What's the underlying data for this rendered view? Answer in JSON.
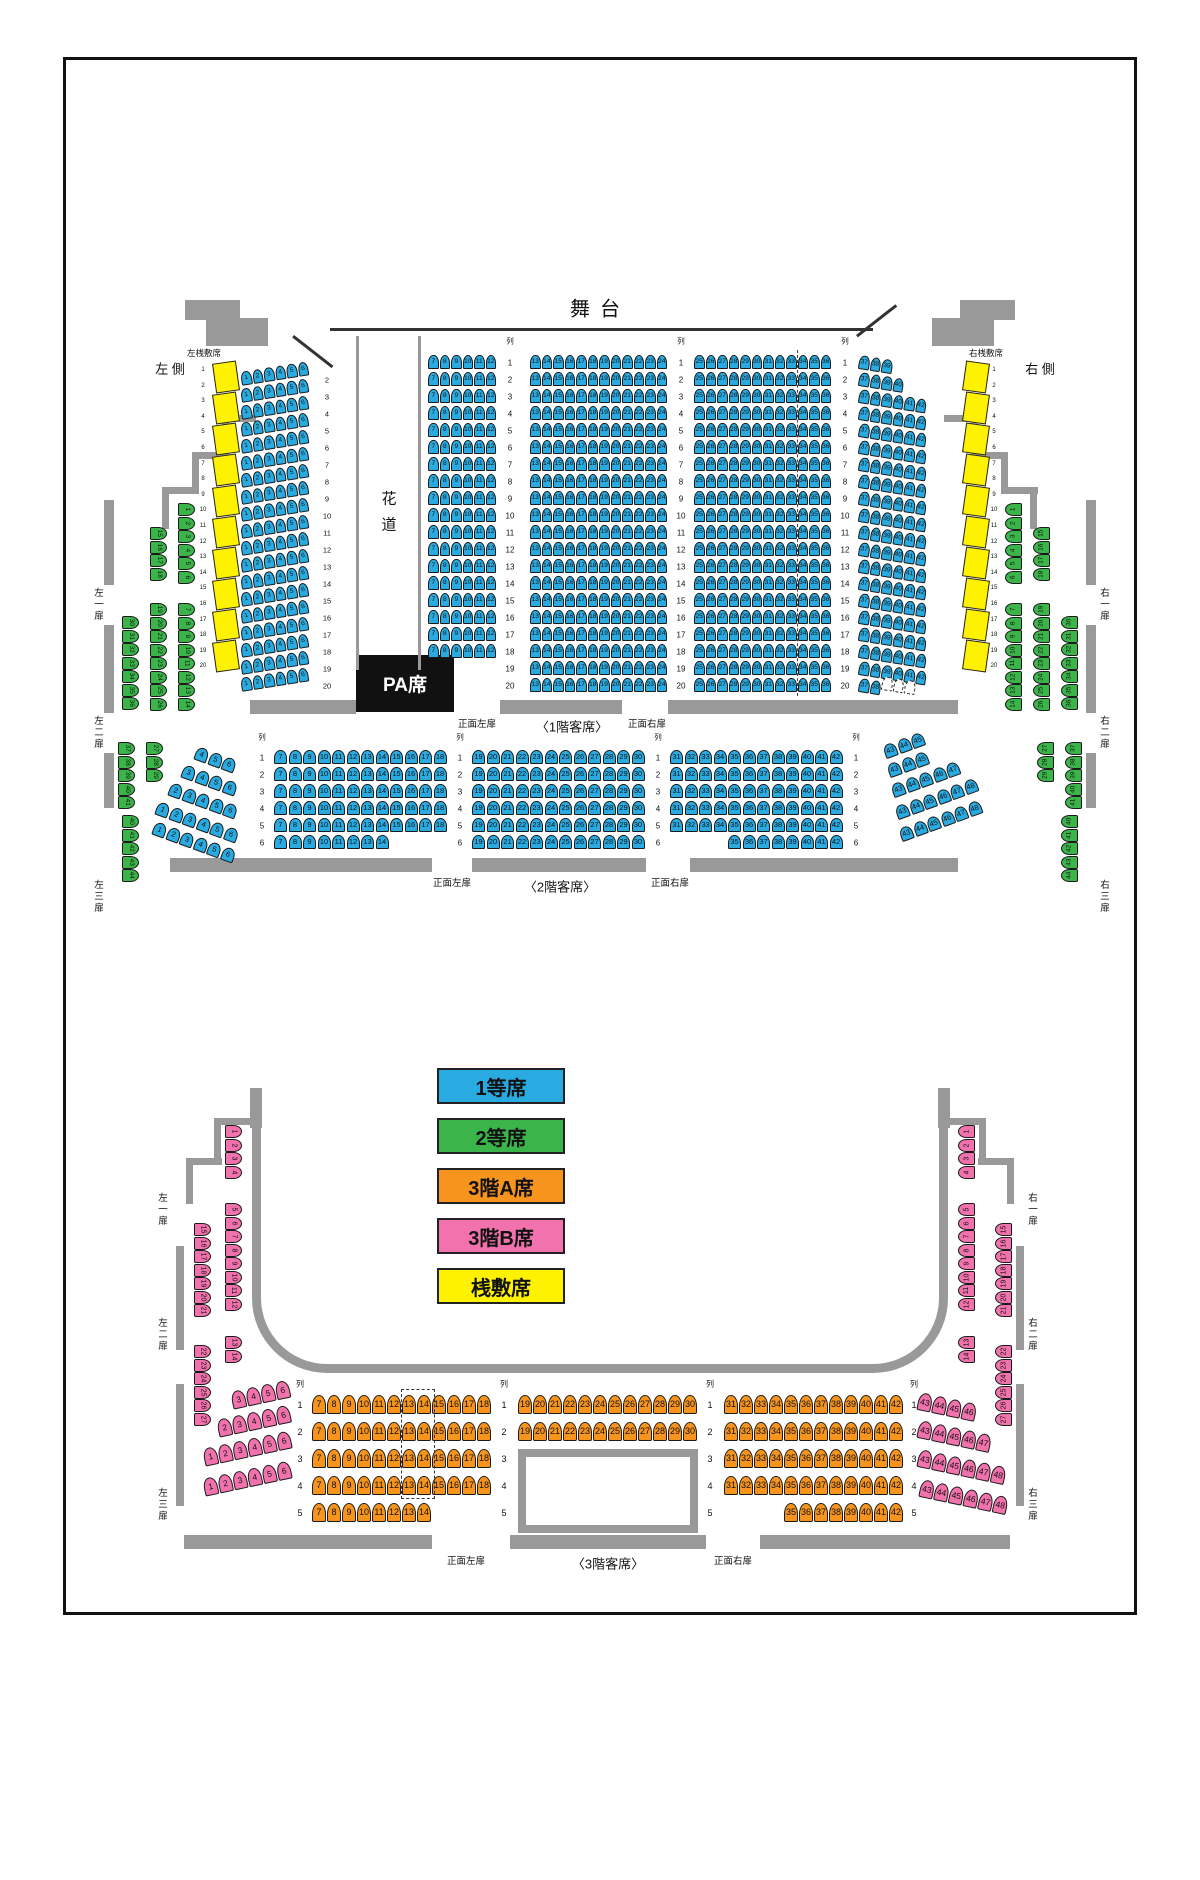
{
  "colors": {
    "blue": "#29ABE2",
    "green": "#3BB54A",
    "orange": "#F7941E",
    "pink": "#F172AC",
    "yellow": "#FFF200",
    "wall": "#999999",
    "pa": "#111111"
  },
  "stage": {
    "label": "舞台"
  },
  "hanamichi": {
    "char1": "花",
    "char2": "道"
  },
  "pa": {
    "label": "PA席"
  },
  "legend": {
    "x": 437,
    "y": 1068,
    "w": 128,
    "h": 36,
    "gap": 50,
    "items": [
      {
        "label": "1等席",
        "color": "blue"
      },
      {
        "label": "2等席",
        "color": "green"
      },
      {
        "label": "3階A席",
        "color": "orange"
      },
      {
        "label": "3階B席",
        "color": "pink"
      },
      {
        "label": "桟敷席",
        "color": "yellow"
      }
    ]
  },
  "labels": [
    {
      "name": "row-header",
      "text": "列",
      "x": 510,
      "y": 341,
      "fs": 7.5
    },
    {
      "name": "row-header",
      "text": "列",
      "x": 681,
      "y": 341,
      "fs": 7.5
    },
    {
      "name": "row-header",
      "text": "列",
      "x": 845,
      "y": 341,
      "fs": 7.5
    },
    {
      "name": "row-header",
      "text": "列",
      "x": 262,
      "y": 737,
      "fs": 7.5
    },
    {
      "name": "row-header",
      "text": "列",
      "x": 460,
      "y": 737,
      "fs": 7.5
    },
    {
      "name": "row-header",
      "text": "列",
      "x": 658,
      "y": 737,
      "fs": 7.5
    },
    {
      "name": "row-header",
      "text": "列",
      "x": 856,
      "y": 737,
      "fs": 7.5
    },
    {
      "name": "row-header",
      "text": "列",
      "x": 300,
      "y": 1384,
      "fs": 8
    },
    {
      "name": "row-header",
      "text": "列",
      "x": 504,
      "y": 1384,
      "fs": 8
    },
    {
      "name": "row-header",
      "text": "列",
      "x": 710,
      "y": 1384,
      "fs": 8
    },
    {
      "name": "row-header",
      "text": "列",
      "x": 914,
      "y": 1384,
      "fs": 8
    },
    {
      "name": "hanamichi-char",
      "text": "花",
      "x": 389,
      "y": 498,
      "fs": 15
    },
    {
      "name": "hanamichi-char",
      "text": "道",
      "x": 389,
      "y": 524,
      "fs": 15
    },
    {
      "name": "left-sajiki-title",
      "text": "左桟敷席",
      "x": 204,
      "y": 353,
      "fs": 8.5
    },
    {
      "name": "right-sajiki-title",
      "text": "右桟敷席",
      "x": 986,
      "y": 353,
      "fs": 8.5
    },
    {
      "name": "left-side-title",
      "text": "左 側",
      "x": 170,
      "y": 368,
      "fs": 13
    },
    {
      "name": "right-side-title",
      "text": "右 側",
      "x": 1040,
      "y": 368,
      "fs": 13
    },
    {
      "name": "door-label",
      "text": "左一扉",
      "x": 97,
      "y": 605,
      "fs": 9.5,
      "vert": true
    },
    {
      "name": "door-label",
      "text": "左二扉",
      "x": 97,
      "y": 733,
      "fs": 9.5,
      "vert": true
    },
    {
      "name": "door-label",
      "text": "左三扉",
      "x": 97,
      "y": 897,
      "fs": 9.5,
      "vert": true
    },
    {
      "name": "door-label",
      "text": "右一扉",
      "x": 1103,
      "y": 605,
      "fs": 9.5,
      "vert": true
    },
    {
      "name": "door-label",
      "text": "右二扉",
      "x": 1103,
      "y": 733,
      "fs": 9.5,
      "vert": true
    },
    {
      "name": "door-label",
      "text": "右三扉",
      "x": 1103,
      "y": 897,
      "fs": 9.5,
      "vert": true
    },
    {
      "name": "door-label",
      "text": "正面左扉",
      "x": 477,
      "y": 723,
      "fs": 9.5
    },
    {
      "name": "section-label",
      "text": "〈1階客席〉",
      "x": 572,
      "y": 726,
      "fs": 13
    },
    {
      "name": "door-label",
      "text": "正面右扉",
      "x": 647,
      "y": 723,
      "fs": 9.5
    },
    {
      "name": "door-label",
      "text": "正面左扉",
      "x": 452,
      "y": 882,
      "fs": 9.5
    },
    {
      "name": "section-label",
      "text": "〈2階客席〉",
      "x": 560,
      "y": 886,
      "fs": 13
    },
    {
      "name": "door-label",
      "text": "正面右扉",
      "x": 670,
      "y": 882,
      "fs": 9.5
    },
    {
      "name": "door-label",
      "text": "左一扉",
      "x": 161,
      "y": 1210,
      "fs": 9.5,
      "vert": true
    },
    {
      "name": "door-label",
      "text": "左二扉",
      "x": 161,
      "y": 1335,
      "fs": 9.5,
      "vert": true
    },
    {
      "name": "door-label",
      "text": "左三扉",
      "x": 161,
      "y": 1505,
      "fs": 9.5,
      "vert": true
    },
    {
      "name": "door-label",
      "text": "右一扉",
      "x": 1031,
      "y": 1210,
      "fs": 9.5,
      "vert": true
    },
    {
      "name": "door-label",
      "text": "右二扉",
      "x": 1031,
      "y": 1335,
      "fs": 9.5,
      "vert": true
    },
    {
      "name": "door-label",
      "text": "右三扉",
      "x": 1031,
      "y": 1505,
      "fs": 9.5,
      "vert": true
    },
    {
      "name": "door-label",
      "text": "正面左扉",
      "x": 466,
      "y": 1560,
      "fs": 9.5
    },
    {
      "name": "section-label",
      "text": "〈3階客席〉",
      "x": 608,
      "y": 1563,
      "fs": 13
    },
    {
      "name": "door-label",
      "text": "正面右扉",
      "x": 733,
      "y": 1560,
      "fs": 9.5
    }
  ],
  "rowLabelCols": [
    {
      "x": 327,
      "y": 376,
      "py": 17,
      "items": "2-20",
      "fs": 7.5
    },
    {
      "x": 510,
      "y": 359,
      "py": 17,
      "items": "1-20",
      "fs": 8
    },
    {
      "x": 681,
      "y": 359,
      "py": 17,
      "items": "1-20",
      "fs": 8
    },
    {
      "x": 845,
      "y": 359,
      "py": 17,
      "items": "1-20",
      "fs": 8
    },
    {
      "x": 203,
      "y": 366,
      "py": 15.6,
      "items": "1-20",
      "fs": 6
    },
    {
      "x": 994,
      "y": 366,
      "py": 15.6,
      "items": "1-20",
      "fs": 6
    },
    {
      "x": 262,
      "y": 754,
      "py": 17,
      "items": "1-6",
      "fs": 8
    },
    {
      "x": 460,
      "y": 754,
      "py": 17,
      "items": "1-6",
      "fs": 8
    },
    {
      "x": 658,
      "y": 754,
      "py": 17,
      "items": "1-6",
      "fs": 8
    },
    {
      "x": 856,
      "y": 754,
      "py": 17,
      "items": "1-6",
      "fs": 8
    },
    {
      "x": 300,
      "y": 1401,
      "py": 27,
      "items": "1-5",
      "fs": 9
    },
    {
      "x": 504,
      "y": 1401,
      "py": 27,
      "items": "1-5",
      "fs": 9
    },
    {
      "x": 710,
      "y": 1401,
      "py": 27,
      "items": "1-5",
      "fs": 9
    },
    {
      "x": 914,
      "y": 1401,
      "py": 27,
      "items": "1-5",
      "fs": 9
    }
  ],
  "seatRowGroups": [
    {
      "p": 11.5,
      "w": 10.5,
      "h": 14,
      "fs": 6.5,
      "c": "blue",
      "rows": [
        {
          "x": 240,
          "y": 372,
          "n": 19,
          "dy": 17,
          "rot": -9,
          "seats": "1-6"
        },
        {
          "x": 428,
          "y": 355,
          "n": 18,
          "dy": 17,
          "seats": "7-12"
        },
        {
          "x": 530,
          "y": 355,
          "n": 20,
          "dy": 17,
          "seats": "13-24"
        },
        {
          "x": 694,
          "y": 355,
          "n": 20,
          "dy": 17,
          "seats": "25-36"
        },
        {
          "x": 860,
          "y": 355,
          "n": 1,
          "rot": 9,
          "seats": "37-39"
        },
        {
          "x": 860,
          "y": 372,
          "n": 1,
          "rot": 9,
          "seats": "37-40"
        },
        {
          "x": 860,
          "y": 389,
          "n": 17,
          "dy": 17,
          "rot": 9,
          "seats": "37-42"
        },
        {
          "x": 860,
          "y": 678,
          "n": 1,
          "rot": 9,
          "seats": "37-38"
        },
        {
          "x": 883,
          "y": 676,
          "n": 1,
          "rot": 9,
          "seats": "39-41",
          "dashed": true
        }
      ]
    },
    {
      "p": 14.5,
      "w": 13,
      "h": 14,
      "fs": 7.5,
      "c": "blue",
      "rows": [
        {
          "x": 274,
          "y": 750,
          "n": 5,
          "dy": 17,
          "seats": "7-18"
        },
        {
          "x": 274,
          "y": 835,
          "n": 1,
          "seats": "7-14"
        },
        {
          "x": 472,
          "y": 750,
          "n": 6,
          "dy": 17,
          "seats": "19-30"
        },
        {
          "x": 670,
          "y": 750,
          "n": 5,
          "dy": 17,
          "seats": "31-42"
        },
        {
          "x": 728,
          "y": 835,
          "n": 1,
          "seats": "35-42"
        },
        {
          "x": 198,
          "y": 746,
          "n": 1,
          "rot": 20,
          "seats": "4-6"
        },
        {
          "x": 185,
          "y": 764,
          "n": 1,
          "rot": 20,
          "seats": "3-6"
        },
        {
          "x": 172,
          "y": 782,
          "n": 1,
          "rot": 20,
          "seats": "2-6"
        },
        {
          "x": 159,
          "y": 801,
          "n": 1,
          "rot": 20,
          "seats": "1-6"
        },
        {
          "x": 156,
          "y": 821,
          "n": 1,
          "rot": 20,
          "seats": "1-6"
        },
        {
          "x": 882,
          "y": 746,
          "n": 1,
          "rot": -20,
          "seats": "43-45"
        },
        {
          "x": 886,
          "y": 765,
          "n": 1,
          "rot": -20,
          "seats": "43-45"
        },
        {
          "x": 890,
          "y": 785,
          "n": 1,
          "rot": -20,
          "seats": "43-47"
        },
        {
          "x": 894,
          "y": 807,
          "n": 1,
          "rot": -20,
          "seats": "43-48"
        },
        {
          "x": 898,
          "y": 829,
          "n": 1,
          "rot": -20,
          "seats": "43-48"
        }
      ]
    },
    {
      "p": 15,
      "w": 14,
      "h": 19,
      "fs": 9,
      "c": "orange",
      "rows": [
        {
          "x": 312,
          "y": 1395,
          "n": 4,
          "dy": 27,
          "seats": "7-18"
        },
        {
          "x": 312,
          "y": 1503,
          "n": 1,
          "seats": "7-14"
        },
        {
          "x": 518,
          "y": 1395,
          "n": 2,
          "dy": 27,
          "seats": "19-30"
        },
        {
          "x": 724,
          "y": 1395,
          "n": 4,
          "dy": 27,
          "seats": "31-42"
        },
        {
          "x": 784,
          "y": 1503,
          "n": 1,
          "seats": "35-42"
        }
      ]
    },
    {
      "p": 15,
      "w": 14,
      "h": 18,
      "fs": 8.5,
      "c": "pink",
      "rows": [
        {
          "x": 230,
          "y": 1392,
          "n": 1,
          "rot": -12,
          "seats": "3-6"
        },
        {
          "x": 216,
          "y": 1420,
          "n": 1,
          "rot": -12,
          "seats": "2-6"
        },
        {
          "x": 202,
          "y": 1449,
          "n": 1,
          "rot": -12,
          "seats": "1-6"
        },
        {
          "x": 202,
          "y": 1479,
          "n": 1,
          "rot": -12,
          "seats": "1-6"
        },
        {
          "x": 920,
          "y": 1392,
          "n": 1,
          "rot": 12,
          "seats": "43-46"
        },
        {
          "x": 920,
          "y": 1420,
          "n": 1,
          "rot": 12,
          "seats": "43-47"
        },
        {
          "x": 920,
          "y": 1449,
          "n": 1,
          "rot": 12,
          "seats": "43-48"
        },
        {
          "x": 922,
          "y": 1479,
          "n": 1,
          "rot": 12,
          "seats": "43-48"
        }
      ]
    }
  ],
  "seatColGroups": [
    {
      "w": 17,
      "h": 13,
      "py": 13.5,
      "fs": 6.5,
      "c": "green",
      "cols": [
        {
          "x": 178,
          "y": 503,
          "seats": "1-6",
          "side": "left"
        },
        {
          "x": 150,
          "y": 527,
          "seats": "15-18",
          "side": "left"
        },
        {
          "x": 178,
          "y": 603,
          "seats": "7-14",
          "side": "left"
        },
        {
          "x": 150,
          "y": 603,
          "seats": "19-26",
          "side": "left"
        },
        {
          "x": 122,
          "y": 616,
          "seats": "30-36",
          "side": "left"
        },
        {
          "x": 146,
          "y": 742,
          "seats": "27-29",
          "side": "left"
        },
        {
          "x": 118,
          "y": 742,
          "seats": "37-41",
          "side": "left"
        },
        {
          "x": 122,
          "y": 815,
          "seats": "40-44",
          "side": "left"
        },
        {
          "x": 1005,
          "y": 503,
          "seats": "1-6",
          "side": "right"
        },
        {
          "x": 1033,
          "y": 527,
          "seats": "15-18",
          "side": "right"
        },
        {
          "x": 1005,
          "y": 603,
          "seats": "7-14",
          "side": "right"
        },
        {
          "x": 1033,
          "y": 603,
          "seats": "19-26",
          "side": "right"
        },
        {
          "x": 1061,
          "y": 616,
          "seats": "30-36",
          "side": "right"
        },
        {
          "x": 1037,
          "y": 742,
          "seats": "27-29",
          "side": "right"
        },
        {
          "x": 1065,
          "y": 742,
          "seats": "37-41",
          "side": "right"
        },
        {
          "x": 1061,
          "y": 815,
          "seats": "40-44",
          "side": "right"
        }
      ]
    },
    {
      "w": 17,
      "h": 13,
      "py": 13.5,
      "fs": 7,
      "c": "pink",
      "cols": [
        {
          "x": 225,
          "y": 1125,
          "seats": "1-4",
          "side": "left"
        },
        {
          "x": 225,
          "y": 1203,
          "seats": "5-12",
          "side": "left"
        },
        {
          "x": 225,
          "y": 1336,
          "seats": "13-14",
          "side": "left"
        },
        {
          "x": 194,
          "y": 1223,
          "seats": "15-21",
          "side": "left"
        },
        {
          "x": 194,
          "y": 1345,
          "seats": "22-27",
          "side": "left"
        },
        {
          "x": 958,
          "y": 1125,
          "seats": "1-4",
          "side": "right"
        },
        {
          "x": 958,
          "y": 1203,
          "seats": "5-12",
          "side": "right"
        },
        {
          "x": 958,
          "y": 1336,
          "seats": "13-14",
          "side": "right"
        },
        {
          "x": 995,
          "y": 1223,
          "seats": "15-21",
          "side": "right"
        },
        {
          "x": 995,
          "y": 1345,
          "seats": "22-27",
          "side": "right"
        }
      ]
    }
  ],
  "walls": [
    {
      "x": 330,
      "y": 328,
      "w": 543,
      "h": 3,
      "f": "#333"
    },
    {
      "x": 294,
      "y": 335,
      "w": 50,
      "h": 3,
      "rot": 38,
      "f": "#333"
    },
    {
      "x": 856,
      "y": 335,
      "w": 50,
      "h": 3,
      "rot": -38,
      "f": "#333"
    },
    {
      "x": 185,
      "y": 300,
      "w": 55,
      "h": 20
    },
    {
      "x": 206,
      "y": 318,
      "w": 62,
      "h": 28
    },
    {
      "x": 960,
      "y": 300,
      "w": 55,
      "h": 20
    },
    {
      "x": 932,
      "y": 318,
      "w": 62,
      "h": 28
    },
    {
      "x": 356,
      "y": 336,
      "w": 3,
      "h": 334
    },
    {
      "x": 418,
      "y": 336,
      "w": 3,
      "h": 334
    },
    {
      "x": 222,
      "y": 415,
      "w": 34,
      "h": 7
    },
    {
      "x": 222,
      "y": 415,
      "w": 7,
      "h": 40
    },
    {
      "x": 192,
      "y": 452,
      "w": 37,
      "h": 7
    },
    {
      "x": 192,
      "y": 452,
      "w": 7,
      "h": 38
    },
    {
      "x": 162,
      "y": 487,
      "w": 37,
      "h": 7
    },
    {
      "x": 162,
      "y": 487,
      "w": 7,
      "h": 42
    },
    {
      "x": 944,
      "y": 415,
      "w": 34,
      "h": 7
    },
    {
      "x": 971,
      "y": 415,
      "w": 7,
      "h": 40
    },
    {
      "x": 971,
      "y": 452,
      "w": 37,
      "h": 7
    },
    {
      "x": 1001,
      "y": 452,
      "w": 7,
      "h": 38
    },
    {
      "x": 1001,
      "y": 487,
      "w": 37,
      "h": 7
    },
    {
      "x": 1030,
      "y": 487,
      "w": 7,
      "h": 42
    },
    {
      "x": 104,
      "y": 500,
      "w": 10,
      "h": 85
    },
    {
      "x": 104,
      "y": 625,
      "w": 10,
      "h": 88
    },
    {
      "x": 104,
      "y": 753,
      "w": 10,
      "h": 55
    },
    {
      "x": 1086,
      "y": 500,
      "w": 10,
      "h": 85
    },
    {
      "x": 1086,
      "y": 625,
      "w": 10,
      "h": 88
    },
    {
      "x": 1086,
      "y": 753,
      "w": 10,
      "h": 55
    },
    {
      "x": 250,
      "y": 700,
      "w": 106,
      "h": 14
    },
    {
      "x": 500,
      "y": 700,
      "w": 122,
      "h": 14
    },
    {
      "x": 668,
      "y": 700,
      "w": 290,
      "h": 14
    },
    {
      "x": 170,
      "y": 858,
      "w": 262,
      "h": 14
    },
    {
      "x": 472,
      "y": 858,
      "w": 174,
      "h": 14
    },
    {
      "x": 690,
      "y": 858,
      "w": 268,
      "h": 14
    },
    {
      "x": 250,
      "y": 1088,
      "w": 12,
      "h": 40
    },
    {
      "x": 214,
      "y": 1118,
      "w": 36,
      "h": 7
    },
    {
      "x": 214,
      "y": 1118,
      "w": 7,
      "h": 40
    },
    {
      "x": 186,
      "y": 1158,
      "w": 36,
      "h": 7
    },
    {
      "x": 186,
      "y": 1158,
      "w": 7,
      "h": 46
    },
    {
      "x": 938,
      "y": 1088,
      "w": 12,
      "h": 40
    },
    {
      "x": 950,
      "y": 1118,
      "w": 36,
      "h": 7
    },
    {
      "x": 979,
      "y": 1118,
      "w": 7,
      "h": 40
    },
    {
      "x": 978,
      "y": 1158,
      "w": 36,
      "h": 7
    },
    {
      "x": 1007,
      "y": 1158,
      "w": 7,
      "h": 46
    },
    {
      "x": 176,
      "y": 1246,
      "w": 8,
      "h": 104
    },
    {
      "x": 176,
      "y": 1384,
      "w": 8,
      "h": 122
    },
    {
      "x": 1016,
      "y": 1246,
      "w": 8,
      "h": 104
    },
    {
      "x": 1016,
      "y": 1384,
      "w": 8,
      "h": 122
    },
    {
      "x": 184,
      "y": 1535,
      "w": 248,
      "h": 14
    },
    {
      "x": 510,
      "y": 1535,
      "w": 196,
      "h": 14
    },
    {
      "x": 760,
      "y": 1535,
      "w": 250,
      "h": 14
    }
  ],
  "wedges": {
    "leftX": 214,
    "rightX": 964,
    "yStart": 362,
    "gap": 31,
    "count": 10,
    "w": 22,
    "h": 28
  },
  "specials": {
    "corridor3f": {
      "x": 252,
      "y": 1095,
      "w": 696,
      "h": 278,
      "bw": 9,
      "r": 75
    },
    "void3f": {
      "x": 518,
      "y": 1449,
      "w": 180,
      "h": 84,
      "bw": 8
    },
    "dashedBox3f": {
      "x": 401,
      "y": 1389,
      "w": 32,
      "h": 108
    },
    "dashedLine1f": {
      "x": 797,
      "y": 350,
      "h": 346
    },
    "paBox": {
      "x": 356,
      "y": 655,
      "w": 98,
      "h": 57
    }
  }
}
